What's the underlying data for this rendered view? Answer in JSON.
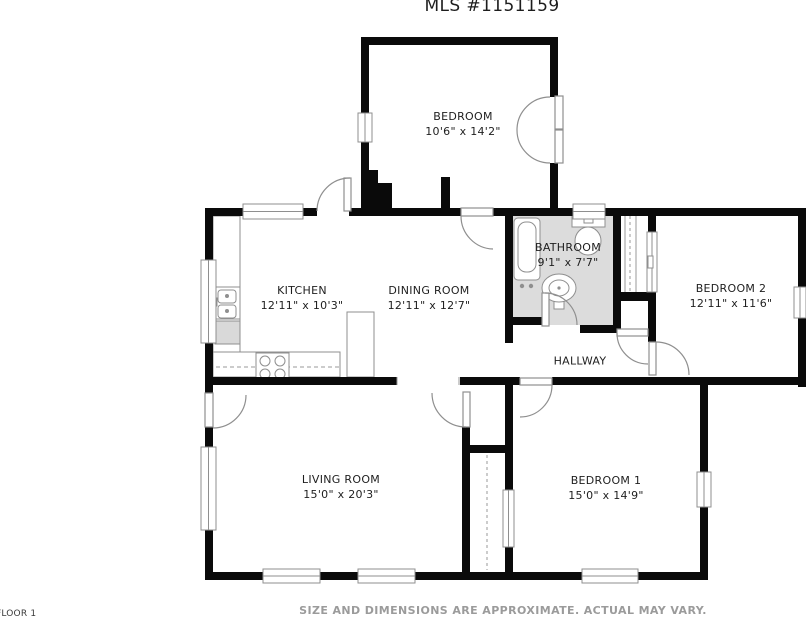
{
  "title": "MLS #1151159",
  "footer": {
    "floor_label": "FLOOR 1",
    "disclaimer": "SIZE AND DIMENSIONS ARE APPROXIMATE. ACTUAL MAY VARY."
  },
  "colors": {
    "wall": "#0a0a0a",
    "bathroom_floor": "#dcdcdc",
    "appliance_fill": "#d9d9d9",
    "symbol_line": "#8f8f8f",
    "label_text": "#1e1e1e",
    "disclaimer_text": "#9b9b9b"
  },
  "rooms": [
    {
      "id": "bedroom-top",
      "name": "BEDROOM",
      "dims": "10'6\" x 14'2\""
    },
    {
      "id": "bathroom",
      "name": "BATHROOM",
      "dims": "9'1\" x 7'7\""
    },
    {
      "id": "bedroom-2",
      "name": "BEDROOM 2",
      "dims": "12'11\" x 11'6\""
    },
    {
      "id": "kitchen",
      "name": "KITCHEN",
      "dims": "12'11\" x 10'3\""
    },
    {
      "id": "dining-room",
      "name": "DINING ROOM",
      "dims": "12'11\" x 12'7\""
    },
    {
      "id": "hallway",
      "name": "HALLWAY",
      "dims": ""
    },
    {
      "id": "living-room",
      "name": "LIVING ROOM",
      "dims": "15'0\" x 20'3\""
    },
    {
      "id": "bedroom-1",
      "name": "BEDROOM 1",
      "dims": "15'0\" x 14'9\""
    }
  ]
}
